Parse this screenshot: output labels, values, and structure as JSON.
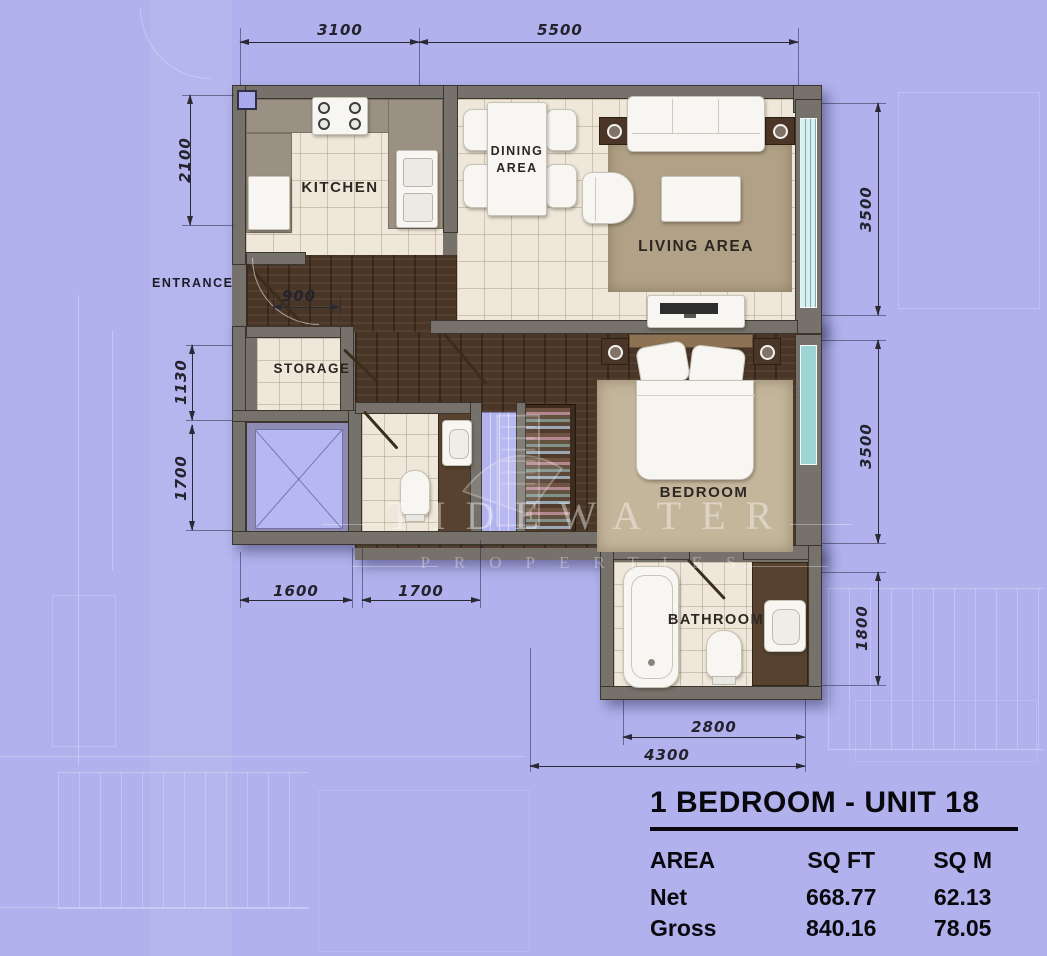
{
  "unit": {
    "title": "1 BEDROOM - UNIT 18",
    "table": {
      "col_area": "AREA",
      "col_sqft": "SQ FT",
      "col_sqm": "SQ M",
      "rows": [
        {
          "label": "Net",
          "sqft": "668.77",
          "sqm": "62.13"
        },
        {
          "label": "Gross",
          "sqft": "840.16",
          "sqm": "78.05"
        }
      ]
    }
  },
  "labels": {
    "entrance": "ENTRANCE",
    "kitchen": "KITCHEN",
    "dining": "DINING AREA",
    "living": "LIVING AREA",
    "storage": "STORAGE",
    "bedroom": "BEDROOM",
    "bathroom": "BATHROOM"
  },
  "dimensions": {
    "top_kitchen": "3100",
    "top_living": "5500",
    "left_kitchen": "2100",
    "left_storage": "1130",
    "left_shaft": "1700",
    "right_living": "3500",
    "right_bedroom": "3500",
    "right_bathroom": "1800",
    "hall_door": "900",
    "bottom_shaft": "1600",
    "bottom_powder": "1700",
    "bottom_bathroom": "2800",
    "bottom_overall": "4300"
  },
  "watermark": {
    "name": "TIDEWATER",
    "subtitle": "PROPERTIES"
  },
  "colors": {
    "background": "#b1b2ed",
    "wall": "#76726b",
    "tile_floor": "#efe8da",
    "wood_floor": "#4a3626",
    "counter": "#9a9083",
    "vanity": "#56422f",
    "living_rug": "#b1a287",
    "bedroom_rug": "#c4b69b",
    "window_glass": "#d8f0f1",
    "dimension_ink": "#2a2a35",
    "table_ink": "#08080d"
  }
}
